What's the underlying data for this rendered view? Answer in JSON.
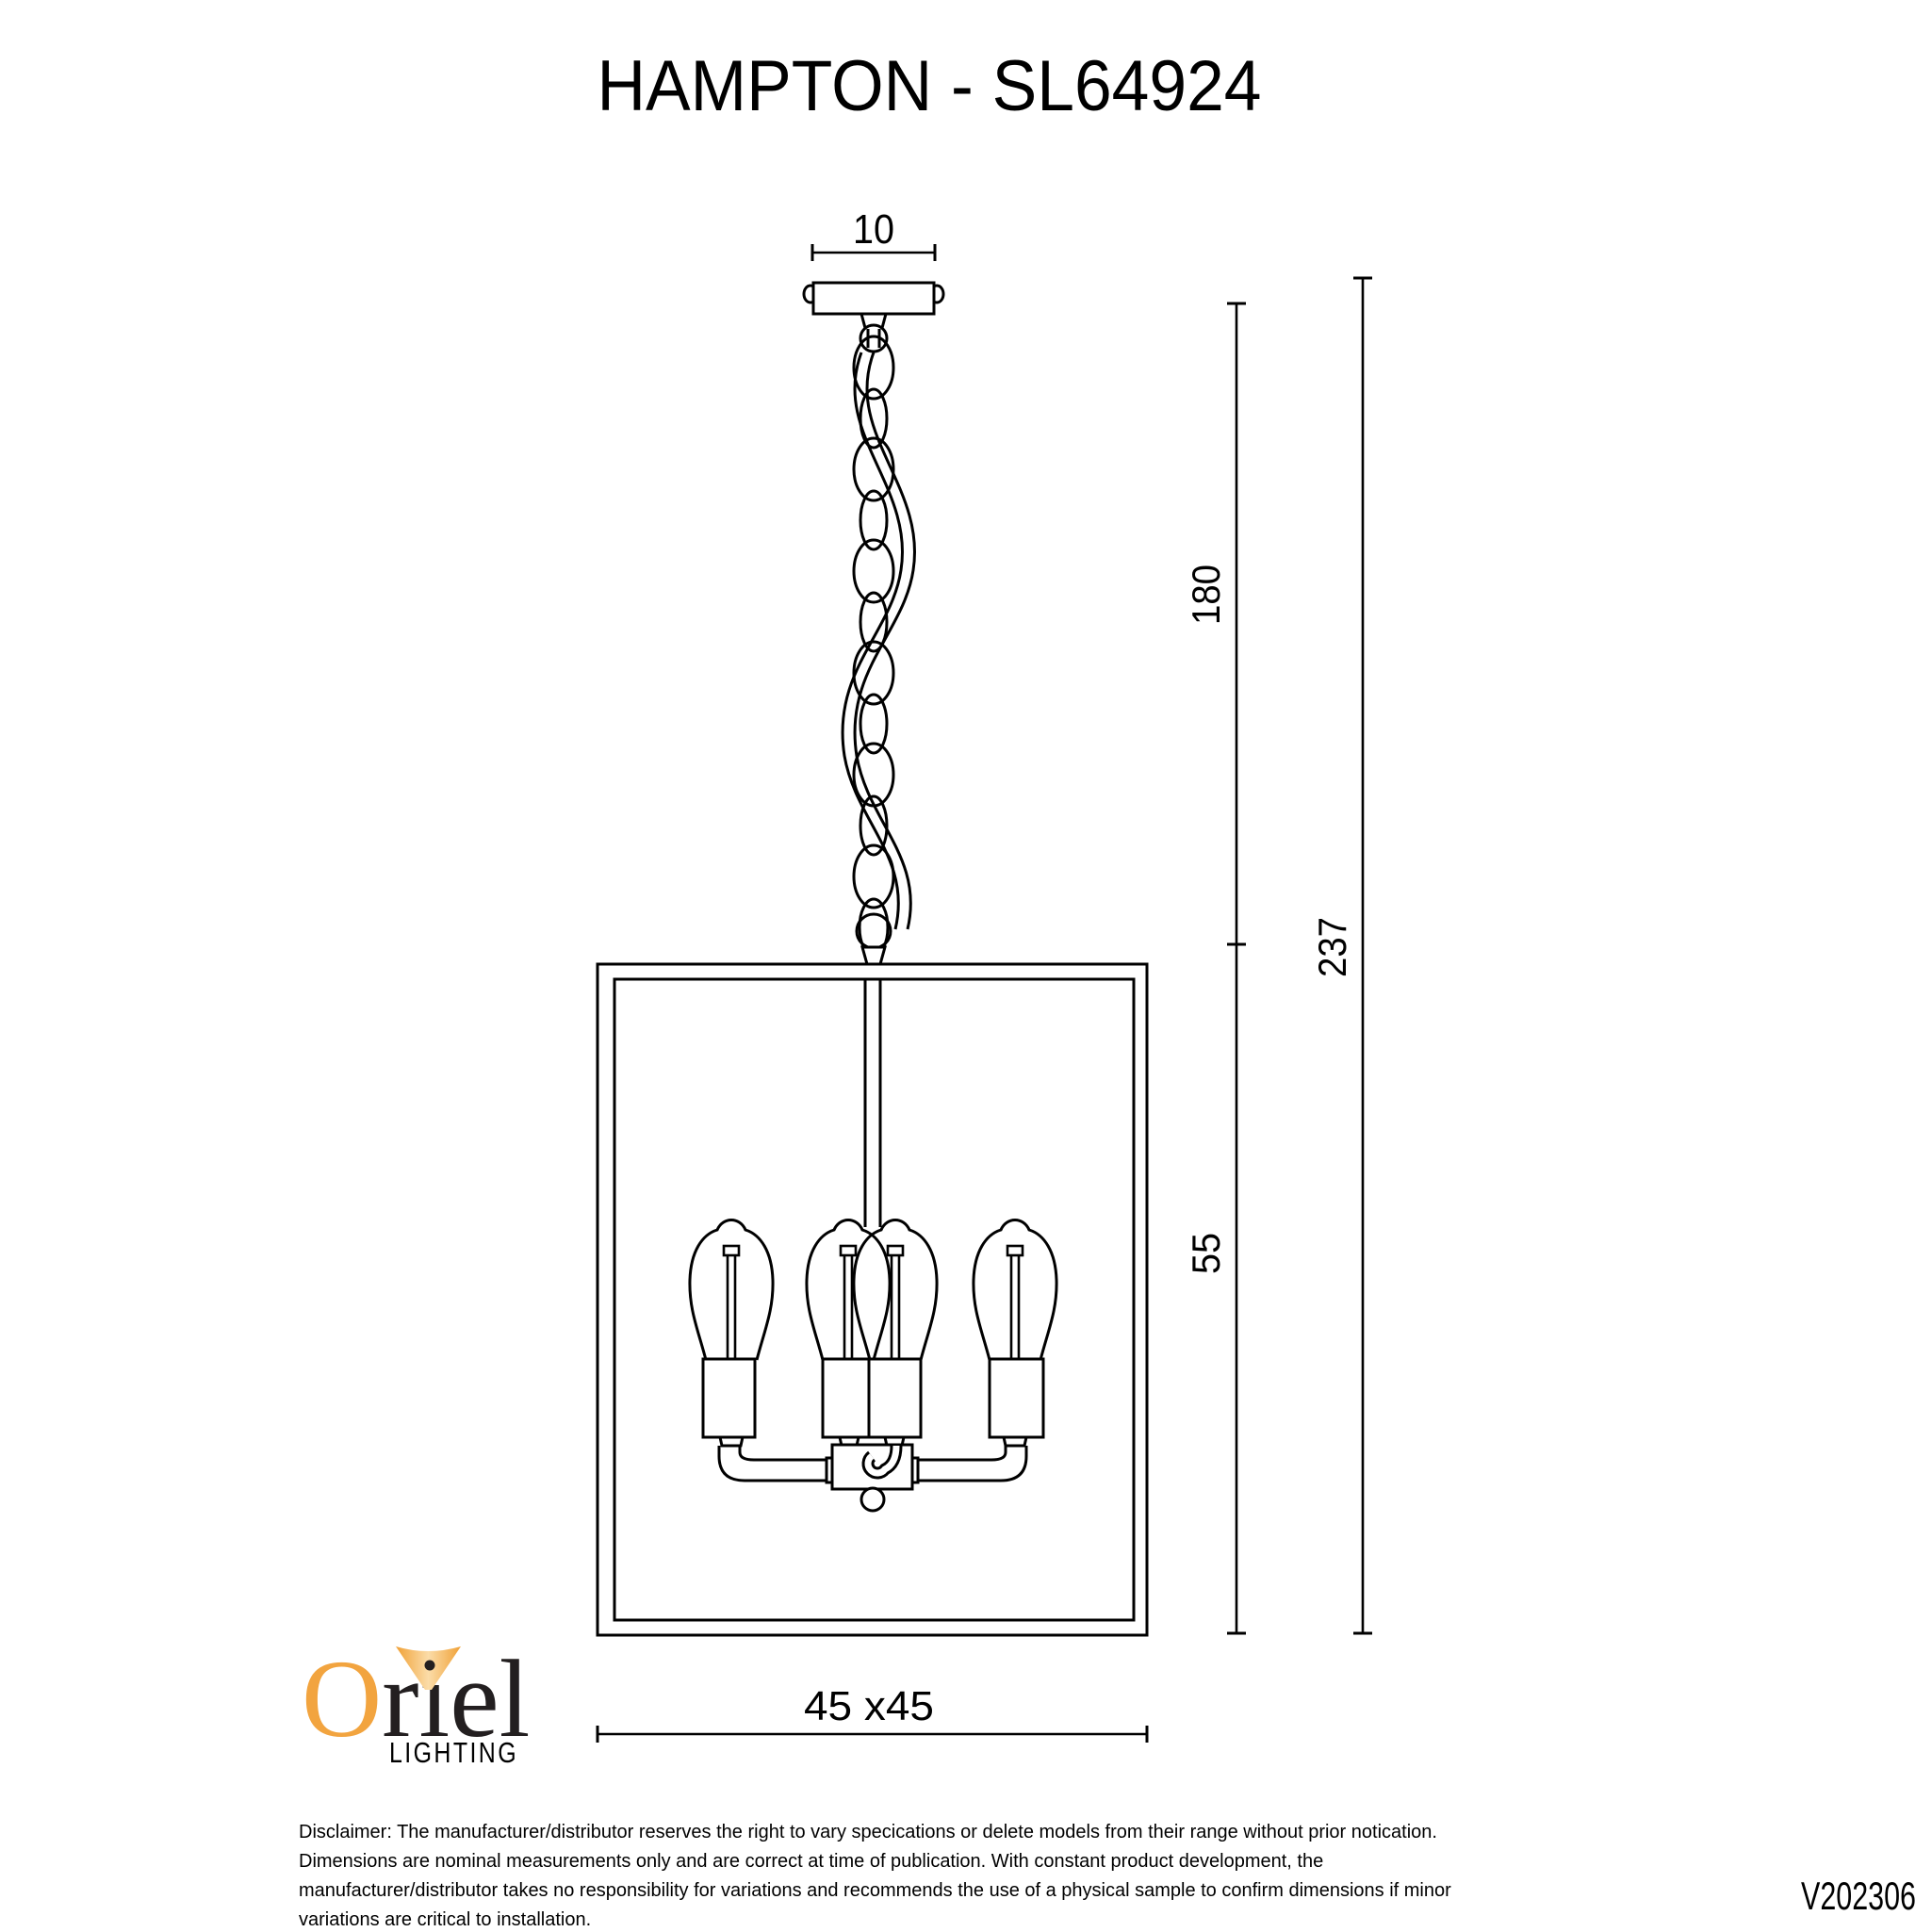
{
  "title": "HAMPTON - SL64924",
  "dimensions": {
    "canopy_width": "10",
    "chain_drop": "180",
    "cage_height": "55",
    "total_drop": "237",
    "width_depth": "45 x45"
  },
  "logo": {
    "brand_first_letter": "O",
    "brand_rest": "riel",
    "tagline": "LIGHTING"
  },
  "disclaimer": {
    "lines": [
      "Disclaimer: The manufacturer/distributor reserves the right to vary specications or delete models from their range without prior notication.",
      "Dimensions are nominal measurements only and are correct at time of publication. With constant product development, the",
      "manufacturer/distributor takes no responsibility for variations and recommends the use of a physical sample to confirm dimensions if minor",
      "variations are critical to installation."
    ]
  },
  "version": "V202306",
  "colors": {
    "line": "#000000",
    "logo_orange": "#F2A43F",
    "logo_dark": "#231F20",
    "tagline_dark": "#2E2A2B",
    "version_gray": "#6F6F6F"
  }
}
